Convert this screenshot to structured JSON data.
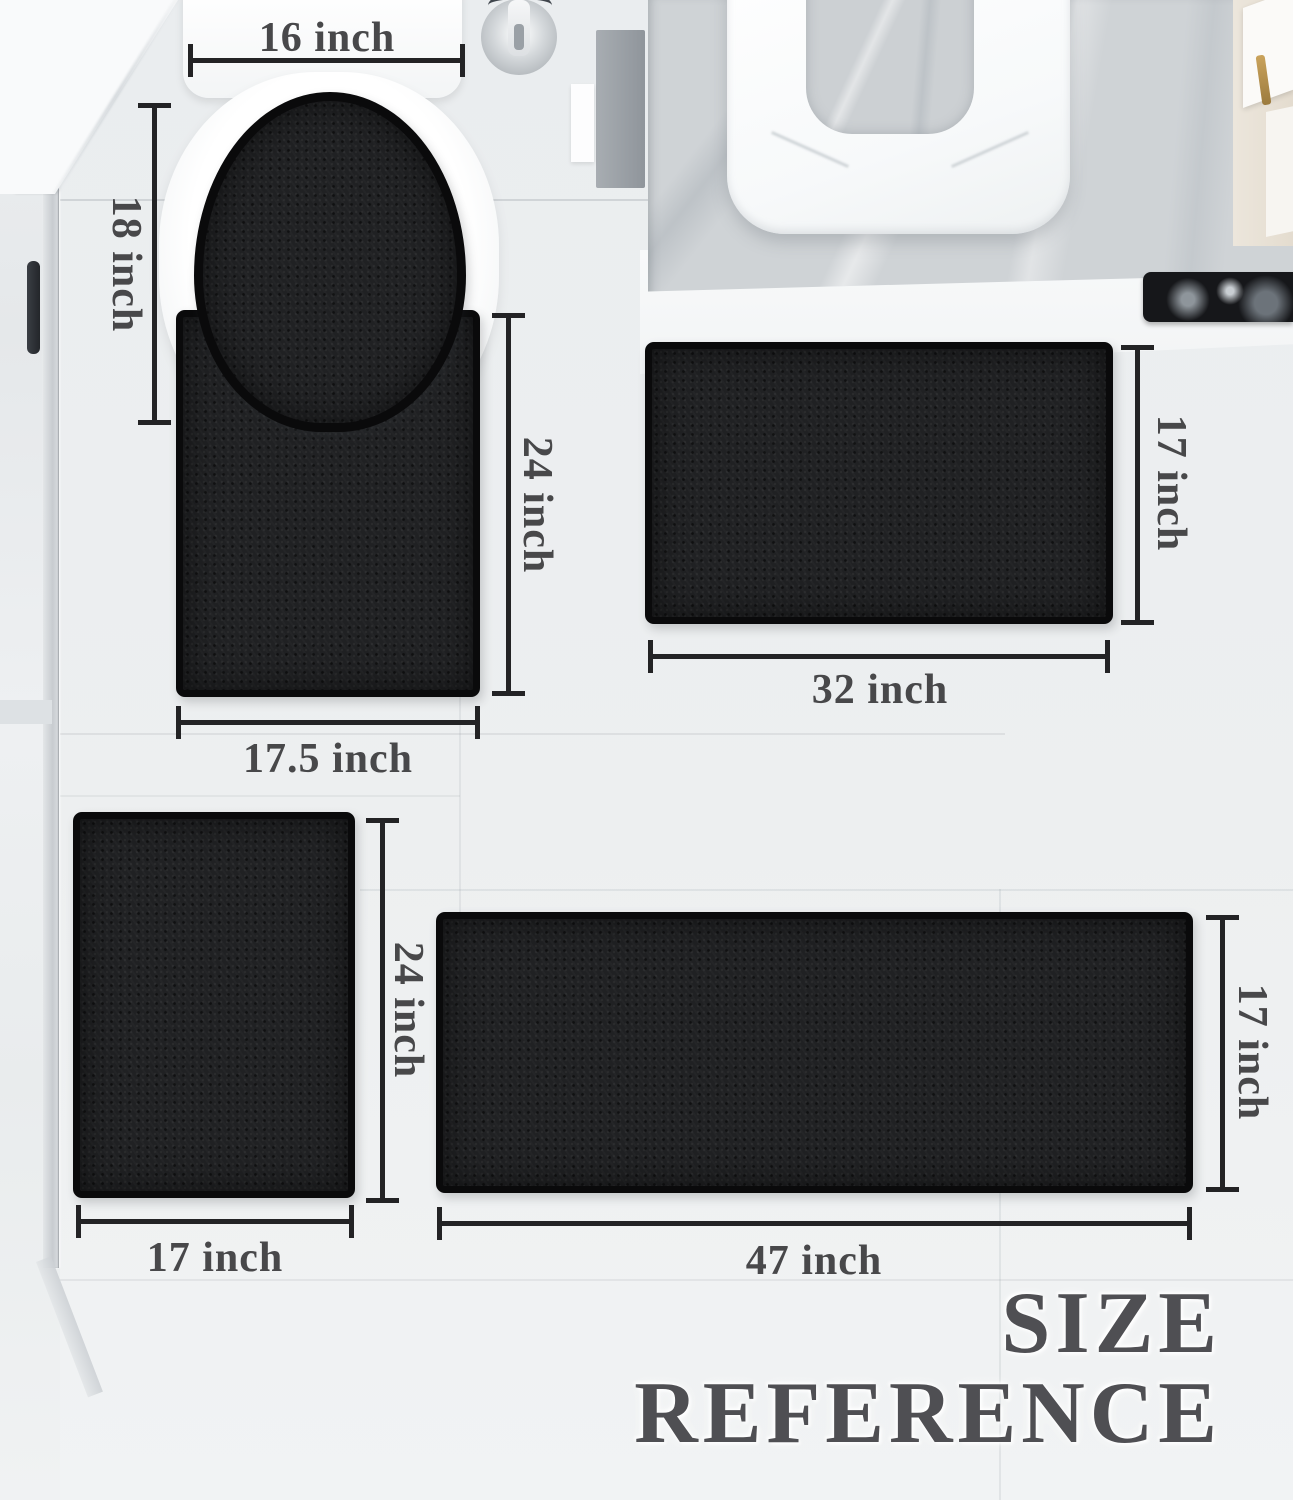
{
  "title": {
    "line1": "SIZE",
    "line2": "REFERENCE"
  },
  "labels": {
    "lid_width": "16 inch",
    "lid_height": "18 inch",
    "contour_height": "24 inch",
    "contour_width": "17.5 inch",
    "medium_height": "17 inch",
    "medium_width": "32 inch",
    "small_height": "24 inch",
    "small_width": "17 inch",
    "runner_height": "17 inch",
    "runner_width": "47 inch"
  },
  "colors": {
    "mat": "#1f2022",
    "mat_border": "#0a0a0b",
    "dimension_line": "#232325",
    "dimension_label": "#48484a",
    "title_text": "#4f4f53",
    "floor": "#edeff0",
    "marble_floor": "#cfd3d6",
    "cabinet_gold": "#b9924d"
  }
}
